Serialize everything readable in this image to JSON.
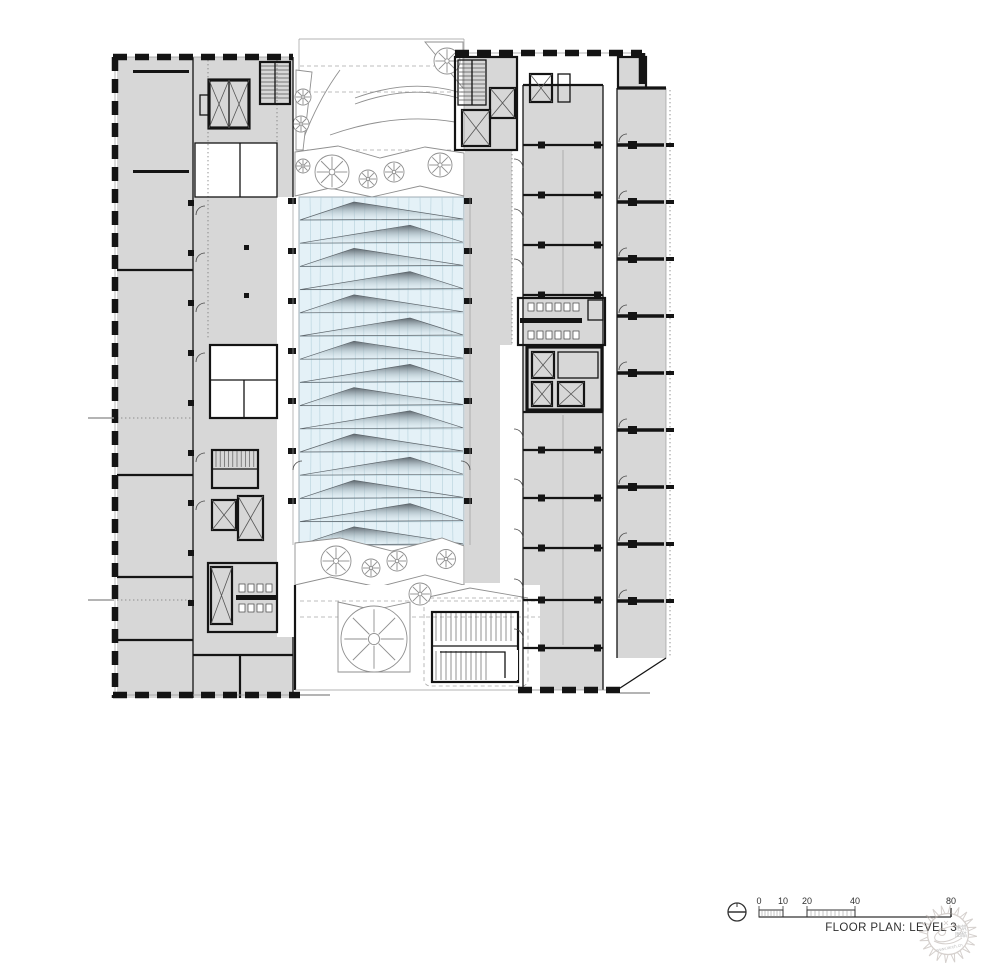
{
  "colors": {
    "wall": "#141414",
    "room_fill": "#d7d7d7",
    "glass_fill": "#e4f1f7",
    "glass_line": "#a8c8d4",
    "landscape_line": "#8f8f8f",
    "text": "#2f2f2f",
    "watermark": "#b3aaa5"
  },
  "plan": {
    "name": "floor-plan-level-3",
    "atrium": {
      "louver_count": 15,
      "pier_rows": 7
    },
    "right_wing": {
      "divider_rows_upper": [
        145,
        195,
        245,
        295
      ],
      "divider_rows_lower": [
        450,
        498,
        548,
        600,
        648
      ]
    },
    "unit_column": {
      "count": 9,
      "first_divider_y": 145,
      "pitch": 57
    },
    "west_pier_rows": [
      200,
      250,
      300,
      350,
      400,
      450,
      500,
      550,
      600
    ]
  },
  "title_block": {
    "title": "FLOOR PLAN: LEVEL 3",
    "scale": {
      "labels": [
        "0",
        "10",
        "20",
        "40",
        "80"
      ]
    }
  },
  "watermark": {
    "chars_top": "建筑",
    "chars_bottom": "图酷",
    "url": "www.iarch.cn"
  }
}
